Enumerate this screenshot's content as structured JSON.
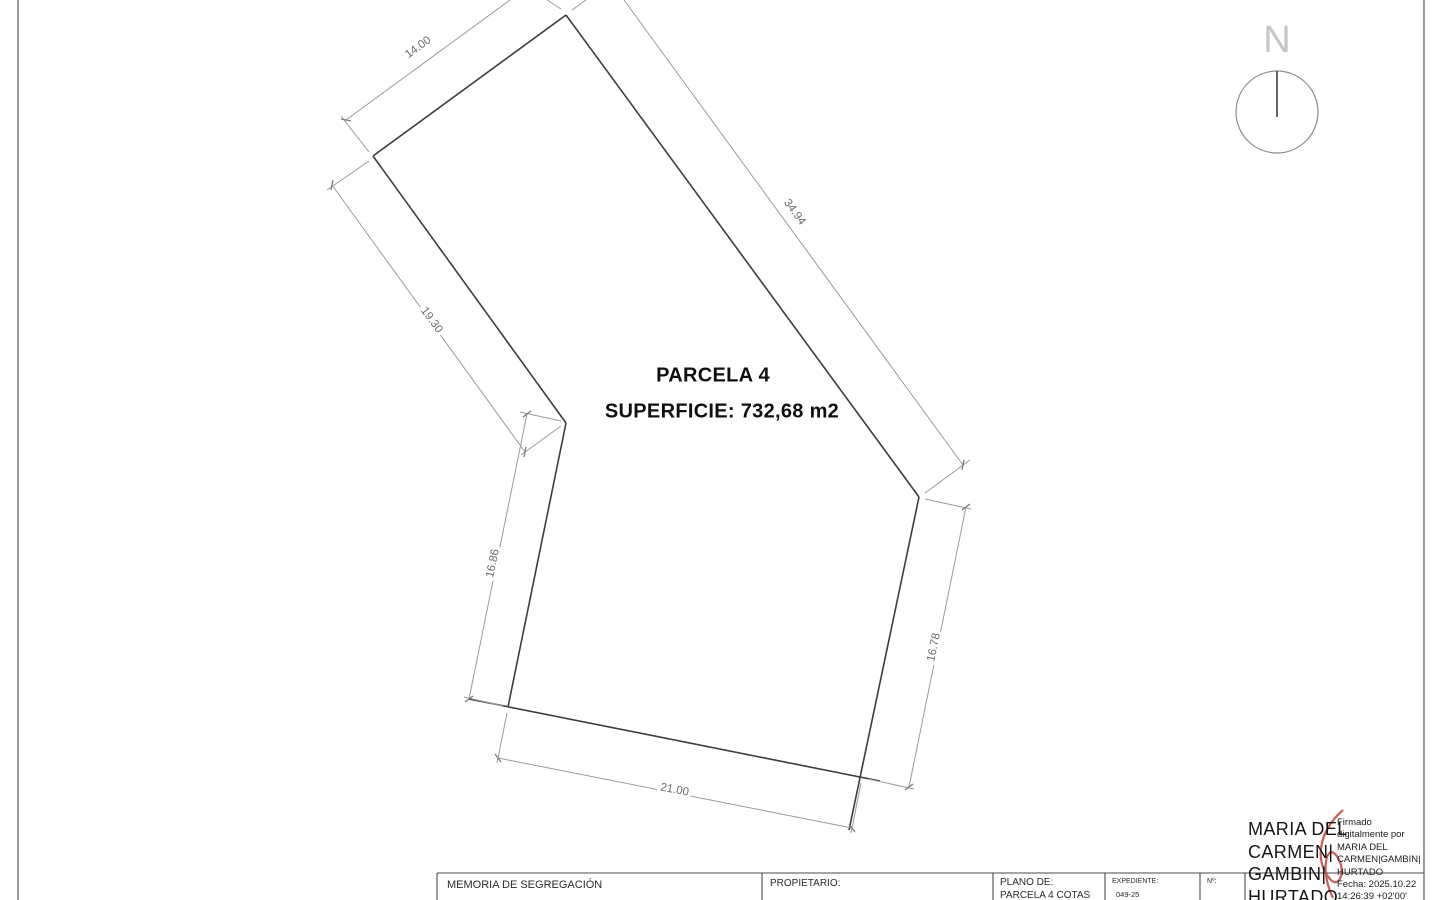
{
  "compass": {
    "north_label": "N"
  },
  "parcel": {
    "name": "PARCELA 4",
    "area_label": "SUPERFICIE: 732,68 m2",
    "dimensions": {
      "top_left": "14.00",
      "right": "34.94",
      "upper_left": "19.30",
      "lower_left": "16.86",
      "lower_right": "16.78",
      "bottom": "21.00"
    }
  },
  "title_block": {
    "document_title": "MEMORIA DE SEGREGACIÓN",
    "owner_label": "PROPIETARIO:",
    "plan_label": "PLANO DE:",
    "plan_value": "PARCELA 4 COTAS",
    "file_label": "EXPEDIENTE:",
    "file_value": "049-25",
    "number_label": "Nº:"
  },
  "signature": {
    "name_lines": [
      "MARIA DEL",
      "CARMEN|",
      "GAMBIN|",
      "HURTADO"
    ],
    "detail_lines": [
      "Firmado",
      "digitalmente por",
      "MARIA DEL",
      "CARMEN|GAMBIN|",
      "HURTADO",
      "Fecha: 2025.10.22",
      "14:26:39 +02'00'"
    ]
  },
  "colors": {
    "outline": "#3d3d3d",
    "dimension_line": "#9a9a9a",
    "dimension_text": "#6b6b6b",
    "signature_accent": "#c0443a"
  }
}
